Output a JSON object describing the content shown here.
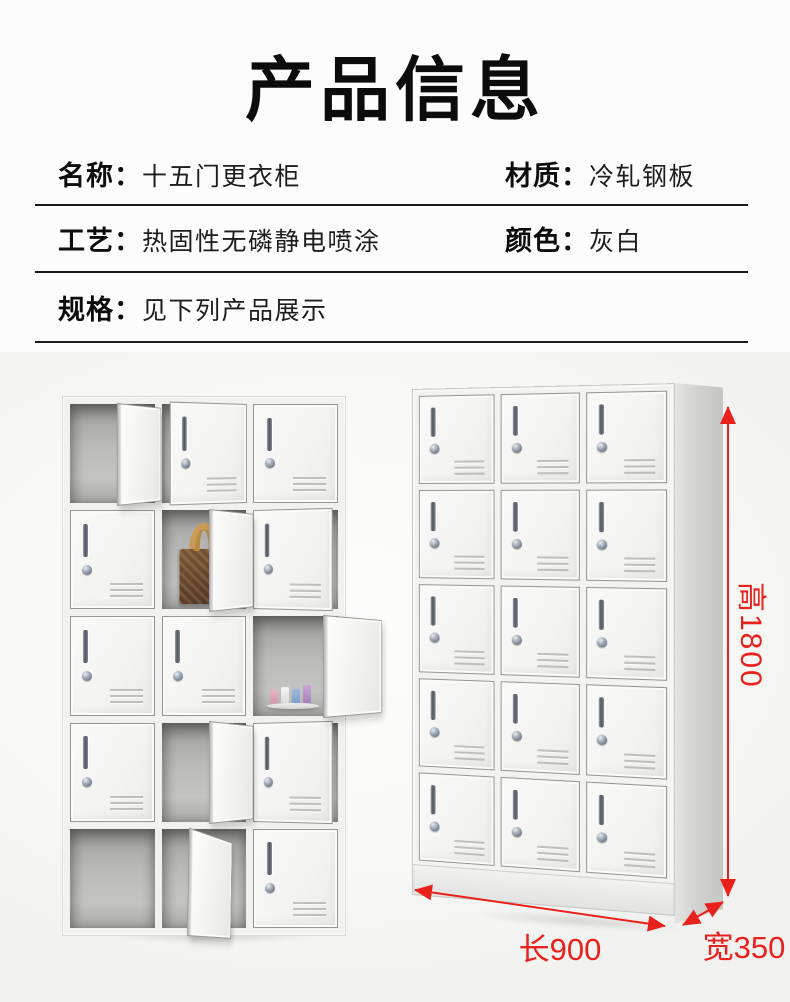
{
  "header": {
    "title": "产品信息"
  },
  "specs": {
    "rows": [
      {
        "cells": [
          {
            "label": "名称：",
            "value": "十五门更衣柜"
          },
          {
            "label": "材质：",
            "value": "冷轧钢板"
          }
        ]
      },
      {
        "cells": [
          {
            "label": "工艺：",
            "value": "热固性无磷静电喷涂"
          },
          {
            "label": "颜色：",
            "value": "灰白"
          }
        ]
      },
      {
        "cells": [
          {
            "label": "规格：",
            "value": "见下列产品展示"
          }
        ]
      }
    ]
  },
  "product_display": {
    "dimension_labels": {
      "height": "高1800",
      "length": "长900",
      "width": "宽350"
    },
    "accent_red": "#e8211c",
    "locker_grid": {
      "rows": 5,
      "columns": 3
    }
  }
}
